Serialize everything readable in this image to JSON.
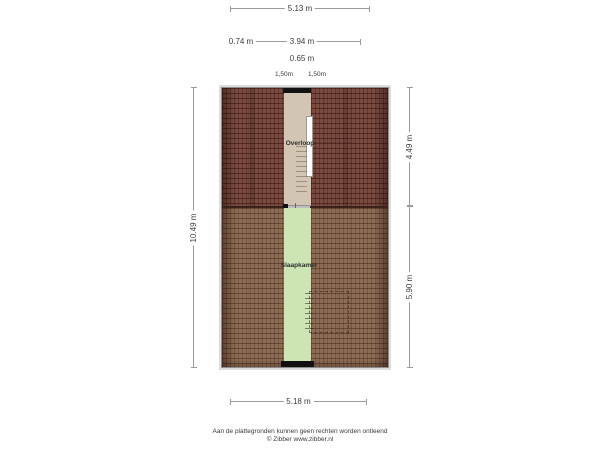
{
  "plan": {
    "rooms": {
      "hallway": "Overloop",
      "bedroom": "Slaapkamer"
    }
  },
  "dims": {
    "top_total": "5.13 m",
    "seg_left": "0.74 m",
    "seg_right": "3.94 m",
    "seg_center": "0.65 m",
    "knee_left": "1,50m",
    "knee_right": "1,50m",
    "side_left_total": "10.49 m",
    "side_right_upper": "4.49 m",
    "side_right_lower": "5.90 m",
    "bottom_total": "5.18 m"
  },
  "footer": {
    "disclaimer": "Aan de plattegronden kunnen geen rechten worden ontleend",
    "credit": "© Zibber www.zibber.nl"
  },
  "colors": {
    "roof_upper": "#7b4b40",
    "roof_lower": "#8d6c55",
    "hallway_floor": "#d2c5b3",
    "bedroom_floor": "#cde4b4",
    "window": "#111111",
    "dimension_line": "#9a9a9a"
  }
}
